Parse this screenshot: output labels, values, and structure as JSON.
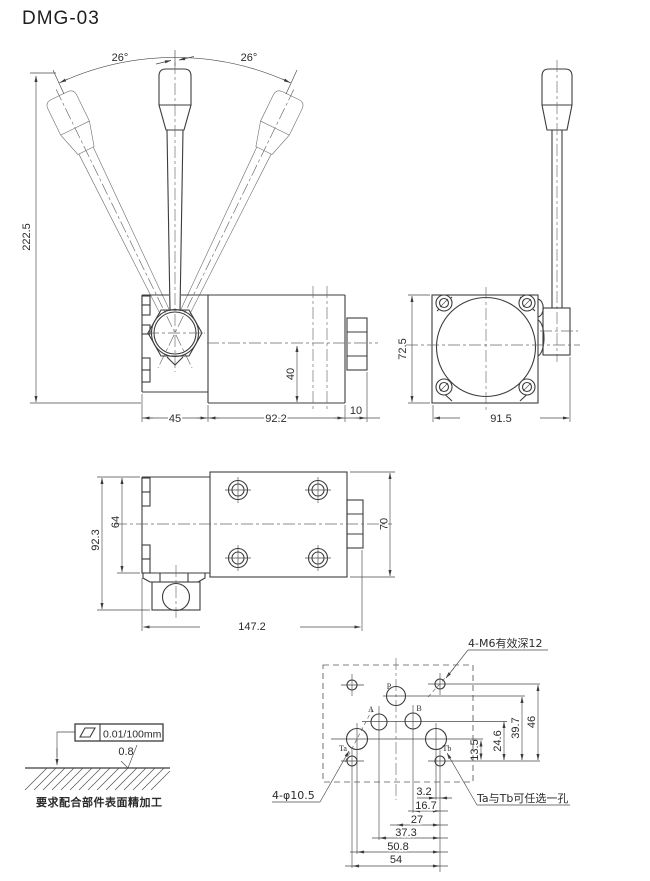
{
  "title": "DMG-03",
  "front_view": {
    "angle_left": "26°",
    "angle_right": "26°",
    "dim_total_height": "222.5",
    "dim_port_depth": "40",
    "dim_lever_block": "45",
    "dim_body": "92.2",
    "dim_end": "10"
  },
  "side_view": {
    "dim_height": "72.5",
    "dim_width": "91.5"
  },
  "top_view": {
    "dim_overall_width": "92.3",
    "dim_block": "64",
    "dim_body_height": "70",
    "dim_length": "147.2"
  },
  "mounting_pattern": {
    "note_threads": "4-M6有效深12",
    "note_holes": "4-φ10.5",
    "note_ports": "Ta与Tb可任选一孔",
    "port_labels": {
      "p": "P",
      "a": "A",
      "b": "B",
      "ta": "Ta",
      "tb": "Tb"
    },
    "dims_vertical": [
      "13.5",
      "24.6",
      "39.7",
      "46"
    ],
    "dims_horizontal": [
      "3.2",
      "16.7",
      "27",
      "37.3",
      "50.8",
      "54"
    ]
  },
  "surface_note": {
    "flatness_tolerance": "0.01/100mm",
    "roughness": "0.8",
    "caption": "要求配合部件表面精加工"
  },
  "colors": {
    "line": "#3c3c3c",
    "background": "#ffffff"
  }
}
